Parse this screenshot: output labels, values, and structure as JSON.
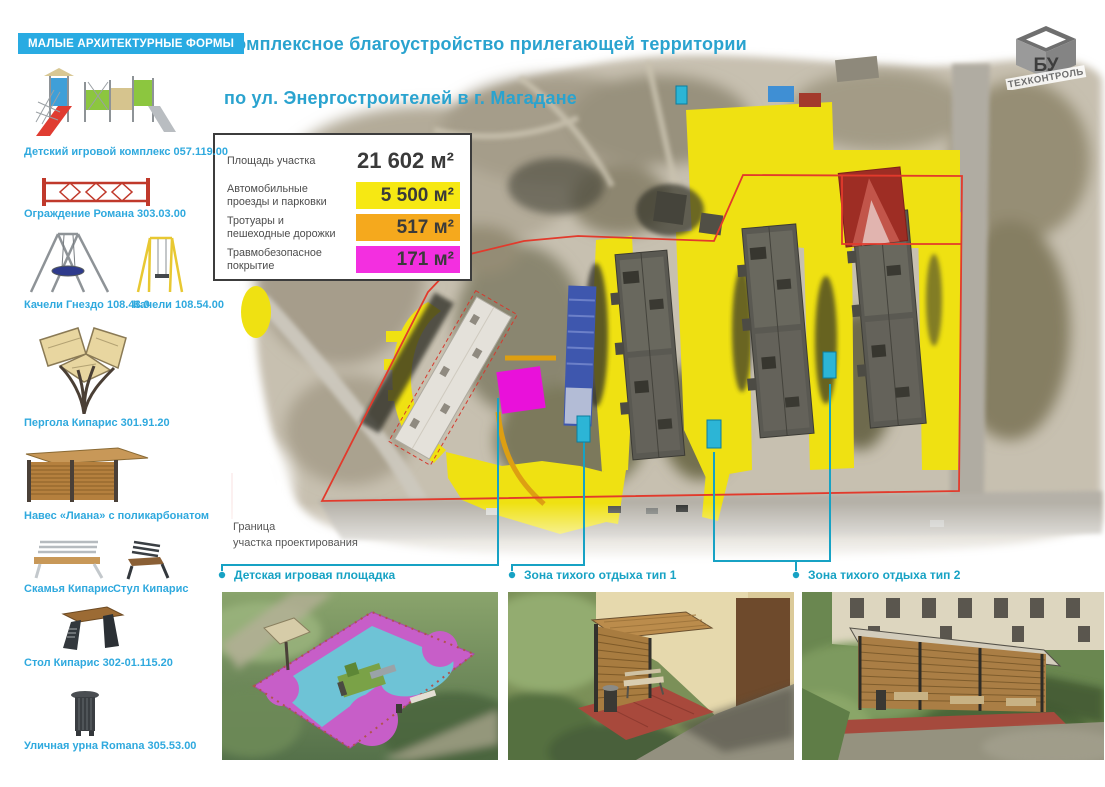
{
  "header": {
    "title_line1": "Комплексное благоустройство прилегающей территории",
    "title_line2": "по ул. Энергостроителей в г. Магадане"
  },
  "logo": {
    "cube_text": "БУ",
    "name": "ТЕХКОНТРОЛЬ"
  },
  "sidebar": {
    "header": "МАЛЫЕ АРХИТЕКТУРНЫЕ ФОРМЫ",
    "items": [
      {
        "label": "Детский игровой комплекс 057.119.00",
        "icon": "play-complex"
      },
      {
        "label": "Ограждение Романа 303.03.00",
        "icon": "fence"
      },
      {
        "label": "Качели Гнездо 108.43.0",
        "icon": "nest-swing"
      },
      {
        "label": "Качели 108.54.00",
        "icon": "swing"
      },
      {
        "label": "Пергола Кипарис 301.91.20",
        "icon": "pergola"
      },
      {
        "label": "Навес «Лиана» с поликарбонатом",
        "icon": "canopy"
      },
      {
        "label": "Скамья Кипарис",
        "icon": "bench"
      },
      {
        "label": "Стул Кипарис",
        "icon": "chair"
      },
      {
        "label": "Стол Кипарис 302-01.115.20",
        "icon": "table"
      },
      {
        "label": "Уличная урна Romana 305.53.00",
        "icon": "urn"
      }
    ]
  },
  "legend": {
    "rows": [
      {
        "label": "Площадь участка",
        "value": "21 602 м²",
        "color": "none"
      },
      {
        "label": "Автомобильные проезды и парковки",
        "value": "5 500 м²",
        "color": "#f6e813"
      },
      {
        "label": "Тротуары и пешеходные дорожки",
        "value": "517 м²",
        "color": "#f5a91d"
      },
      {
        "label": "Травмобезопасное покрытие",
        "value": "171 м²",
        "color": "#f32fe0"
      }
    ]
  },
  "map": {
    "boundary_label_line1": "Граница",
    "boundary_label_line2": "участка проектирования"
  },
  "callouts": [
    {
      "label": "Детская игровая площадка"
    },
    {
      "label": "Зона тихого отдыха тип 1"
    },
    {
      "label": "Зона тихого отдыха тип 2"
    }
  ],
  "colors": {
    "accent_cyan": "#29abe2",
    "title_cyan": "#2aa3cf",
    "callout_teal": "#17a2c4",
    "boundary_red": "#e23a2c",
    "map_yellow": "#efe112",
    "map_magenta": "#e911da",
    "legend_yellow": "#f6e813",
    "legend_orange": "#f5a91d",
    "legend_magenta": "#f32fe0"
  }
}
